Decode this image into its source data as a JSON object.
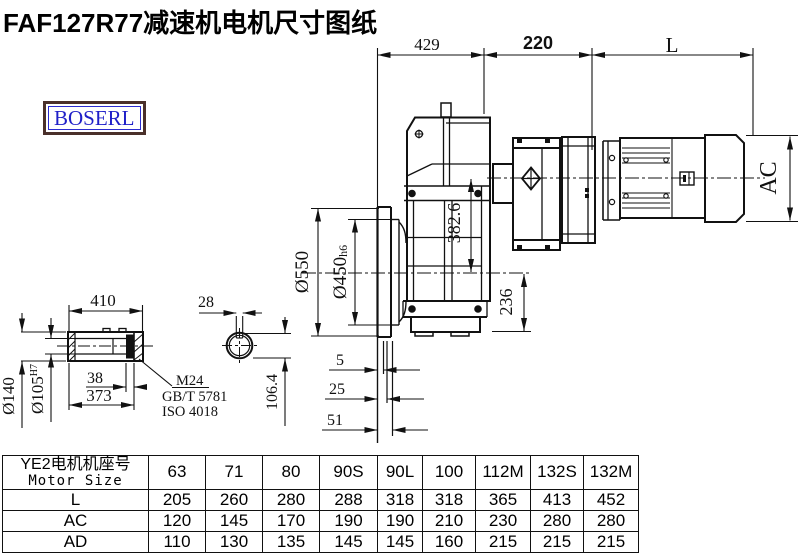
{
  "header": {
    "title": "FAF127R77减速机电机尺寸图纸",
    "logo_text": "BOSERL"
  },
  "dims": {
    "top": {
      "a": "429",
      "b": "220",
      "c": "L"
    },
    "main": {
      "flange_od": "Ø550",
      "pilot": "Ø450",
      "pilot_tol": "h6",
      "axis_height": "382.6",
      "bottom": "236",
      "motor_dia": "AC",
      "f1": "5",
      "f2": "25",
      "f3": "51"
    },
    "shaft": {
      "length": "410",
      "key_width": "28",
      "od": "Ø140",
      "bore": "Ø105",
      "bore_tol": "H7",
      "ring": "38",
      "body": "373",
      "key_height": "106.4",
      "thread": "M24",
      "std1": "GB/T 5781",
      "std2": "ISO 4018"
    }
  },
  "table": {
    "header_cn": "YE2电机机座号",
    "header_en": "Motor Size",
    "columns": [
      "63",
      "71",
      "80",
      "90S",
      "90L",
      "100",
      "112M",
      "132S",
      "132M"
    ],
    "rows": [
      {
        "label": "L",
        "values": [
          "205",
          "260",
          "280",
          "288",
          "318",
          "318",
          "365",
          "413",
          "452"
        ]
      },
      {
        "label": "AC",
        "values": [
          "120",
          "145",
          "170",
          "190",
          "190",
          "210",
          "230",
          "280",
          "280"
        ]
      },
      {
        "label": "AD",
        "values": [
          "110",
          "130",
          "135",
          "145",
          "145",
          "160",
          "215",
          "215",
          "215"
        ]
      }
    ]
  }
}
